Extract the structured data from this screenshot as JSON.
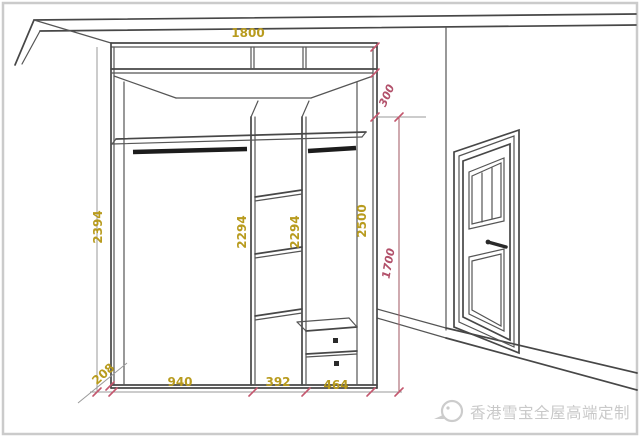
{
  "dimensions": {
    "top_width": "1800",
    "overall_height": "2500",
    "top_section_height": "300",
    "hanging_zone_height": "1700",
    "left_height": "2394",
    "left_column_height": "2294",
    "middle_column_height": "2294",
    "left_column_width": "940",
    "middle_column_width": "392",
    "right_column_width": "464",
    "base_diagonal": "208"
  },
  "watermark": {
    "brand_text": "香港雪宝全屋高端定制"
  },
  "colors": {
    "dim_yellow": "#b89b1e",
    "dim_red": "#b2506a",
    "sketch_line": "#474747",
    "watermark_gray": "#c9c9c9"
  }
}
